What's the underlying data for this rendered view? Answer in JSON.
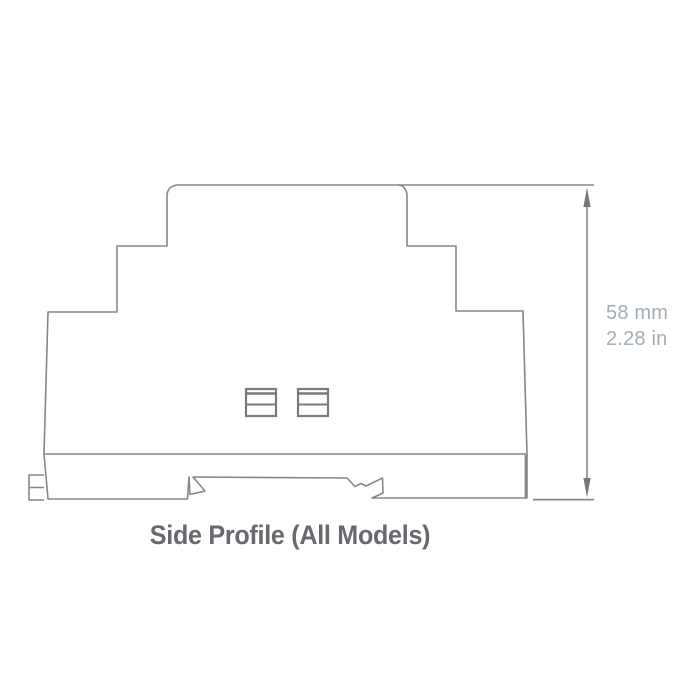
{
  "diagram": {
    "caption": "Side Profile (All Models)",
    "dimension": {
      "metric": "58 mm",
      "imperial": "2.28 in"
    },
    "icons": {
      "arrow_top": "up-arrowhead",
      "arrow_bottom": "down-arrowhead"
    },
    "colors": {
      "outline": "#8a8685",
      "clip_outline": "#7d7977",
      "dimension_text": "#a3adb9",
      "caption_text": "#66696d",
      "background": "#ffffff"
    }
  }
}
